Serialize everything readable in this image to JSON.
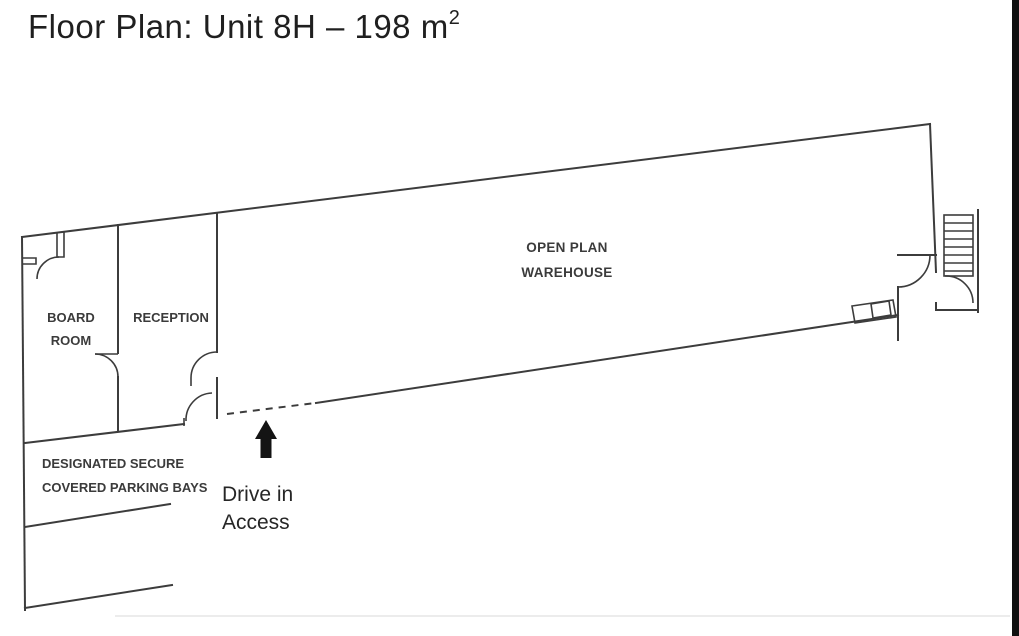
{
  "title": {
    "text": "Floor Plan: Unit 8H – 198 m",
    "sup": "2"
  },
  "plan": {
    "rooms": {
      "board_room": {
        "lines": [
          "BOARD",
          "ROOM"
        ]
      },
      "reception": {
        "label": "RECEPTION"
      },
      "warehouse": {
        "lines": [
          "OPEN PLAN",
          "WAREHOUSE"
        ]
      }
    },
    "parking": {
      "lines": [
        "DESIGNATED SECURE",
        "COVERED PARKING BAYS"
      ]
    },
    "drive_in": {
      "lines": [
        "Drive in",
        "Access"
      ],
      "icon": "up-arrow-icon"
    },
    "colors": {
      "wall": "#3c3c3c",
      "label_text": "#3b3b3b",
      "note_text": "#262626",
      "arrow": "#141414",
      "right_edge_bar": "#101010",
      "background": "#ffffff"
    }
  }
}
